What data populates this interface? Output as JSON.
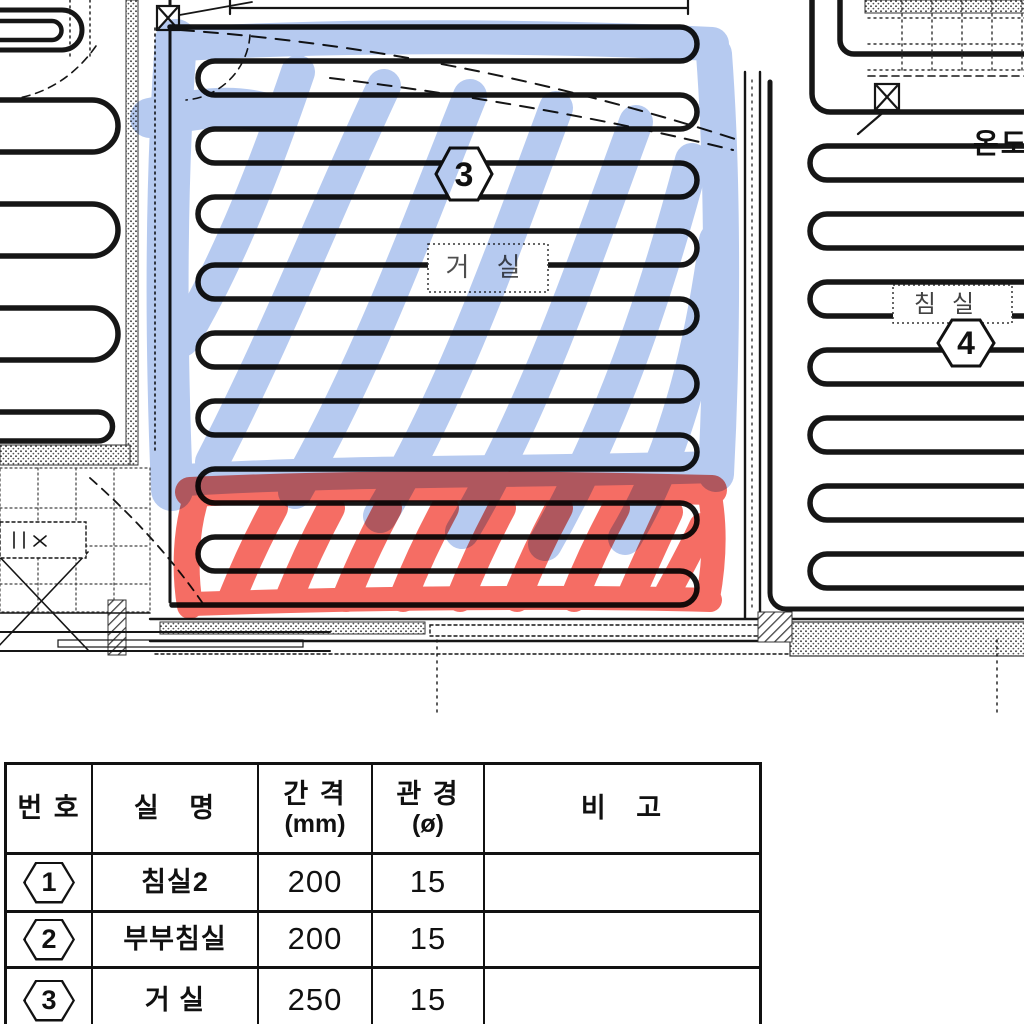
{
  "plan": {
    "living_room": {
      "label": "거 실",
      "marker": "3"
    },
    "bedroom": {
      "label": "침실",
      "marker": "4"
    },
    "thermostat_label": "온도",
    "highlight_colors": {
      "blue": "#6e96e1",
      "red": "#f23a2d"
    }
  },
  "table": {
    "headers": {
      "no": "번 호",
      "room": "실   명",
      "spacing": "간 격",
      "spacing_unit": "(mm)",
      "diameter": "관 경",
      "diameter_unit": "(ø)",
      "remarks": "비   고"
    },
    "rows": [
      {
        "no": "1",
        "room": "침실2",
        "spacing": "200",
        "diameter": "15",
        "remarks": ""
      },
      {
        "no": "2",
        "room": "부부침실",
        "spacing": "200",
        "diameter": "15",
        "remarks": ""
      },
      {
        "no": "3",
        "room": "거 실",
        "spacing": "250",
        "diameter": "15",
        "remarks": ""
      }
    ]
  }
}
